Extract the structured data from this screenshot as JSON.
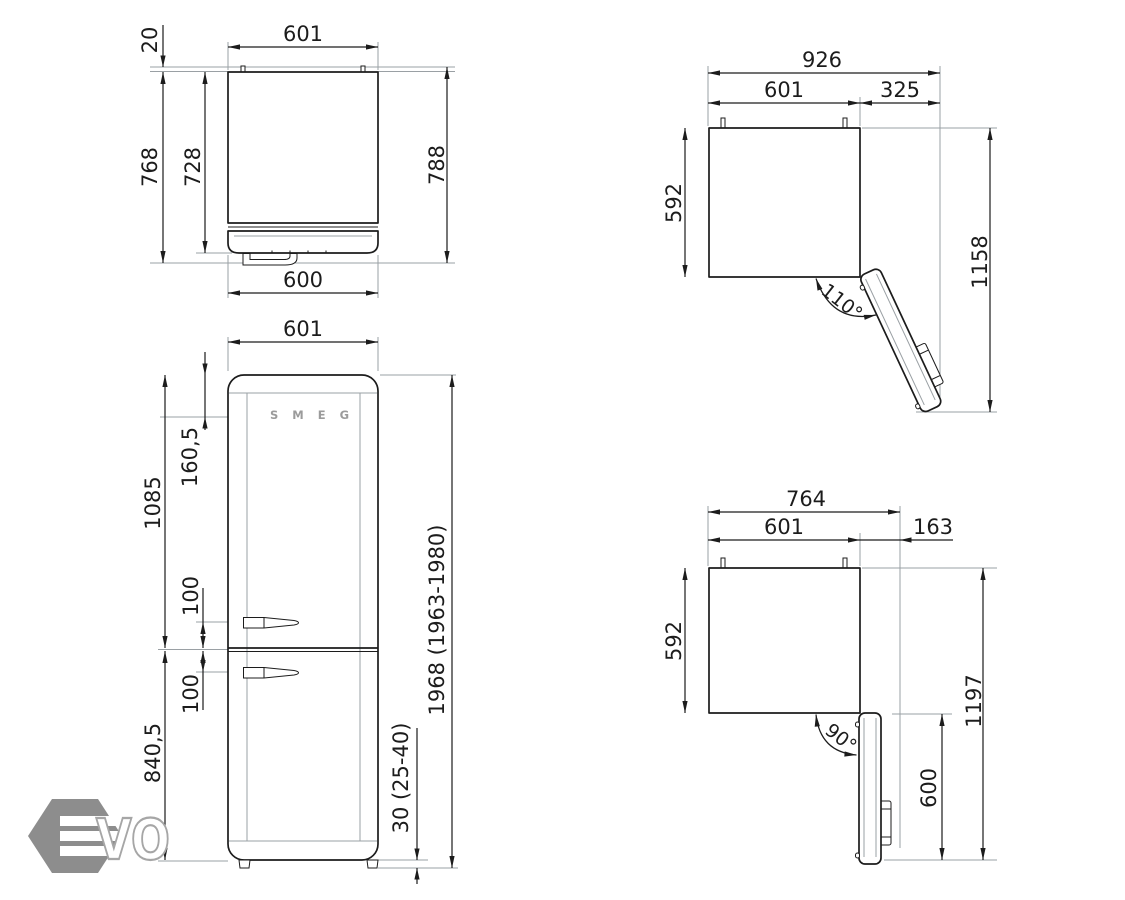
{
  "colors": {
    "line": "#1c1c1c",
    "construction": "#9aa0a4",
    "watermark_hex": "#8d8d8d",
    "watermark_outline": "#a6a6a6",
    "logo_text": "#9b9b9b"
  },
  "front_logo": "SMEG",
  "watermark": {
    "hex_letter": "E",
    "outline_letters": "VO"
  },
  "views": {
    "top_view": {
      "width": "601",
      "wall_gap": "20",
      "depth_body": "768",
      "depth_without_door": "728",
      "depth_overall": "788",
      "door_width": "600"
    },
    "front_view": {
      "width": "601",
      "logo_offset": "160,5",
      "upper_section_height": "1085",
      "handle_above_split": "100",
      "handle_below_split": "100",
      "lower_section_height": "840,5",
      "overall_height": "1968 (1963-1980)",
      "feet_height": "30 (25-40)"
    },
    "open_110": {
      "overall_width": "926",
      "width": "601",
      "door_projection": "325",
      "depth": "592",
      "overall_depth": "1158",
      "angle": "110°"
    },
    "open_90": {
      "overall_width": "764",
      "width": "601",
      "door_projection": "163",
      "depth": "592",
      "overall_depth": "1197",
      "door_length": "600",
      "angle": "90°"
    }
  }
}
